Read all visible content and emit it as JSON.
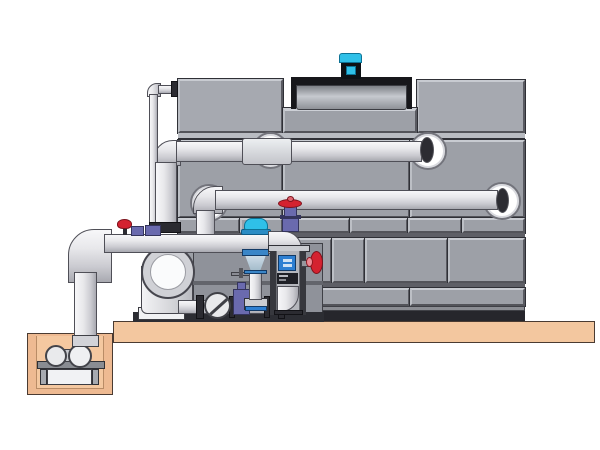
{
  "scene": {
    "title": "Closed-circuit cooling tower with pump skid and sump pit — technical side-view illustration",
    "type": "cad-illustration",
    "background": "#ffffff",
    "text_content": "none"
  },
  "colors": {
    "tower_panel": "#9da0a7",
    "tower_panel_highlight": "#c8cbd1",
    "tower_panel_shadow": "#53545a",
    "tower_outline": "#2f3036",
    "tower_base_dark": "#26262c",
    "fan_shroud_dark": "#17171b",
    "fan_cowl_gray": "#c6c9cf",
    "fan_motor_cyan": "#27c4e9",
    "pipe_white": "#f7f7f9",
    "pipe_shadow": "#a8a9b0",
    "pipe_outline": "#4f4f57",
    "flange_dark": "#2b2b31",
    "concrete_slab_tan": "#f3c79f",
    "pit_tan": "#eeba92",
    "valve_handle_red": "#d42230",
    "valve_body_purple": "#6a6aae",
    "actuator_cap_cyan": "#2fc0e8",
    "component_blue": "#2d7fd2"
  },
  "components": {
    "tower": "cooling tower casing with bolted panels",
    "fan_assembly": "recessed fan cowl with cyan fan motor",
    "supply_pipe": "upper horizontal pipe entering tower top section",
    "return_pipe": "middle horizontal pipe leaving tower mid section",
    "manifold_pipe": "lower pump discharge manifold",
    "makeup_line": "thin vertical make-up water line",
    "pump": "end-suction centrifugal pump with circular inlet face",
    "check_valve": "wafer check valve (circle with diagonal)",
    "gate_valve": "gate valve with T-handle on bottom run",
    "control_valve": "control valve with cyan actuator cap and cone body",
    "isolation_valve": "purple gate valve with red handwheel",
    "side_valve": "red handwheel valve on equipment frame",
    "equipment_frame": "instrument frame column with blue module and elbow",
    "sump_pit": "concrete sump pit with small horizontal pump on stand",
    "slab": "concrete foundation slab"
  }
}
